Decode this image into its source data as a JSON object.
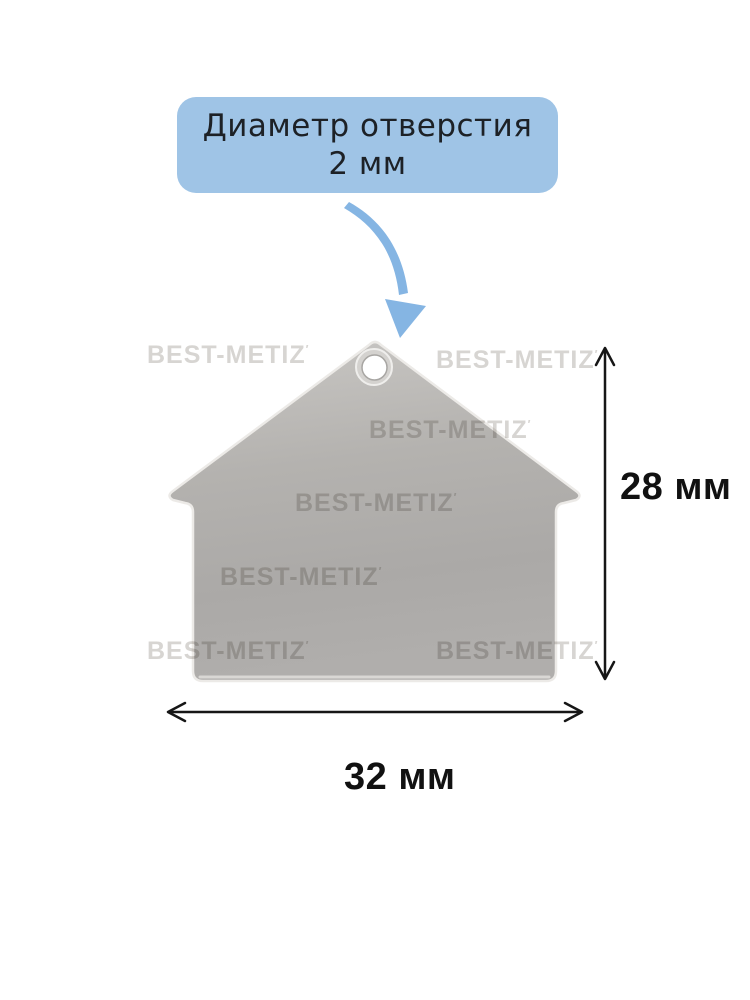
{
  "callout": {
    "line1": "Диаметр отверстия",
    "line2": "2 мм"
  },
  "dimensions": {
    "height_label": "28 мм",
    "width_label": "32 мм"
  },
  "watermark": {
    "text": "BEST-METIZ",
    "mark": "′"
  },
  "product": {
    "shape": "house-shaped-metal-tag"
  },
  "colors": {
    "callout_bg": "#9fc4e6",
    "callout_text": "#1d2126",
    "arrow_blue": "#85b5e3",
    "tag_gray_top": "#c9c7c4",
    "tag_gray_mid": "#b3b1ae",
    "tag_gray_bottom": "#a9a7a5",
    "tag_edge": "#eceae7",
    "dimension_line": "#161616",
    "watermark_gray": "#d7d5d2"
  }
}
